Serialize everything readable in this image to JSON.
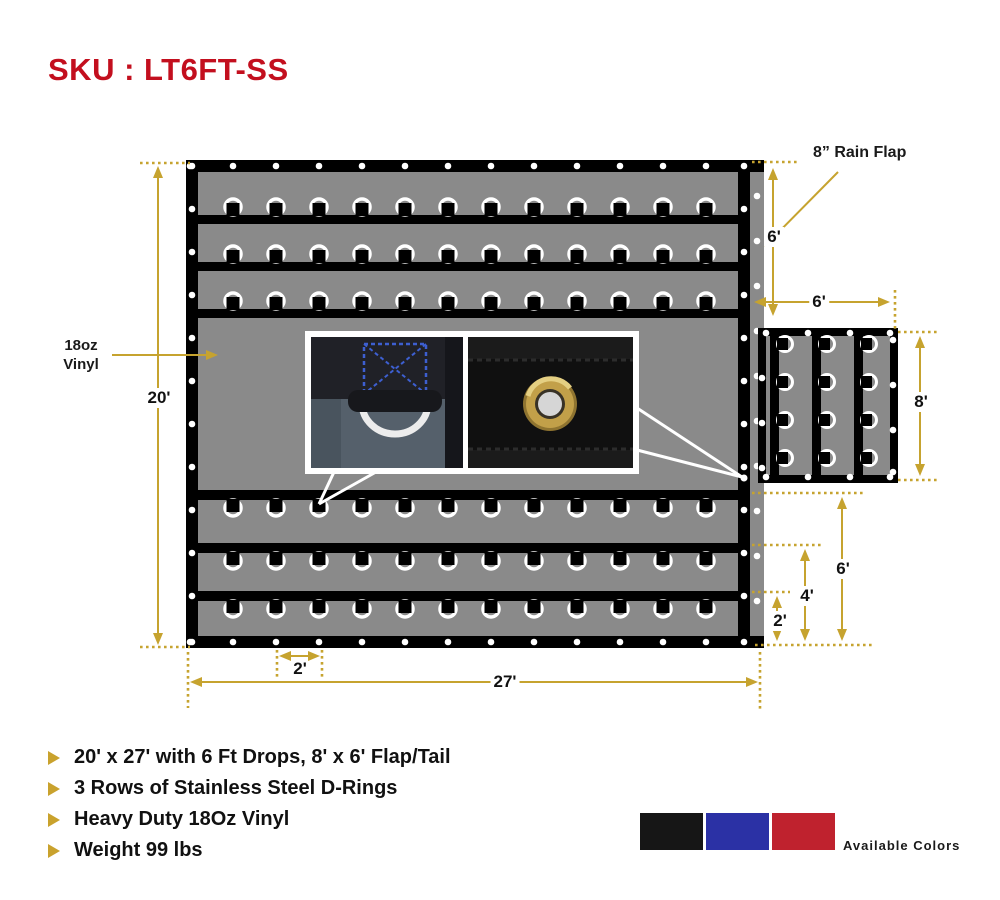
{
  "title": "SKU : LT6FT-SS",
  "labels": {
    "rain_flap": "8” Rain Flap",
    "vinyl_line1": "18oz",
    "vinyl_line2": "Vinyl",
    "available_colors": "Available Colors"
  },
  "dimensions": {
    "tarp_height": "20'",
    "tarp_width": "27'",
    "ring_spacing": "2'",
    "flap_drop": "6'",
    "flap_width": "6'",
    "flap_height": "8'",
    "drop_row_top": "6'",
    "drop_row_mid": "4'",
    "drop_row_low": "2'"
  },
  "features": [
    "20' x 27' with 6 Ft Drops, 8' x 6' Flap/Tail",
    "3 Rows of Stainless Steel D-Rings",
    "Heavy Duty 18Oz Vinyl",
    "Weight 99 lbs"
  ],
  "colors": {
    "accent_gold": "#c6a32f",
    "title_red": "#c30f1e",
    "tarp_gray": "#8a8a8a",
    "swatches": [
      "#161616",
      "#2b31a5",
      "#bf222e"
    ]
  }
}
